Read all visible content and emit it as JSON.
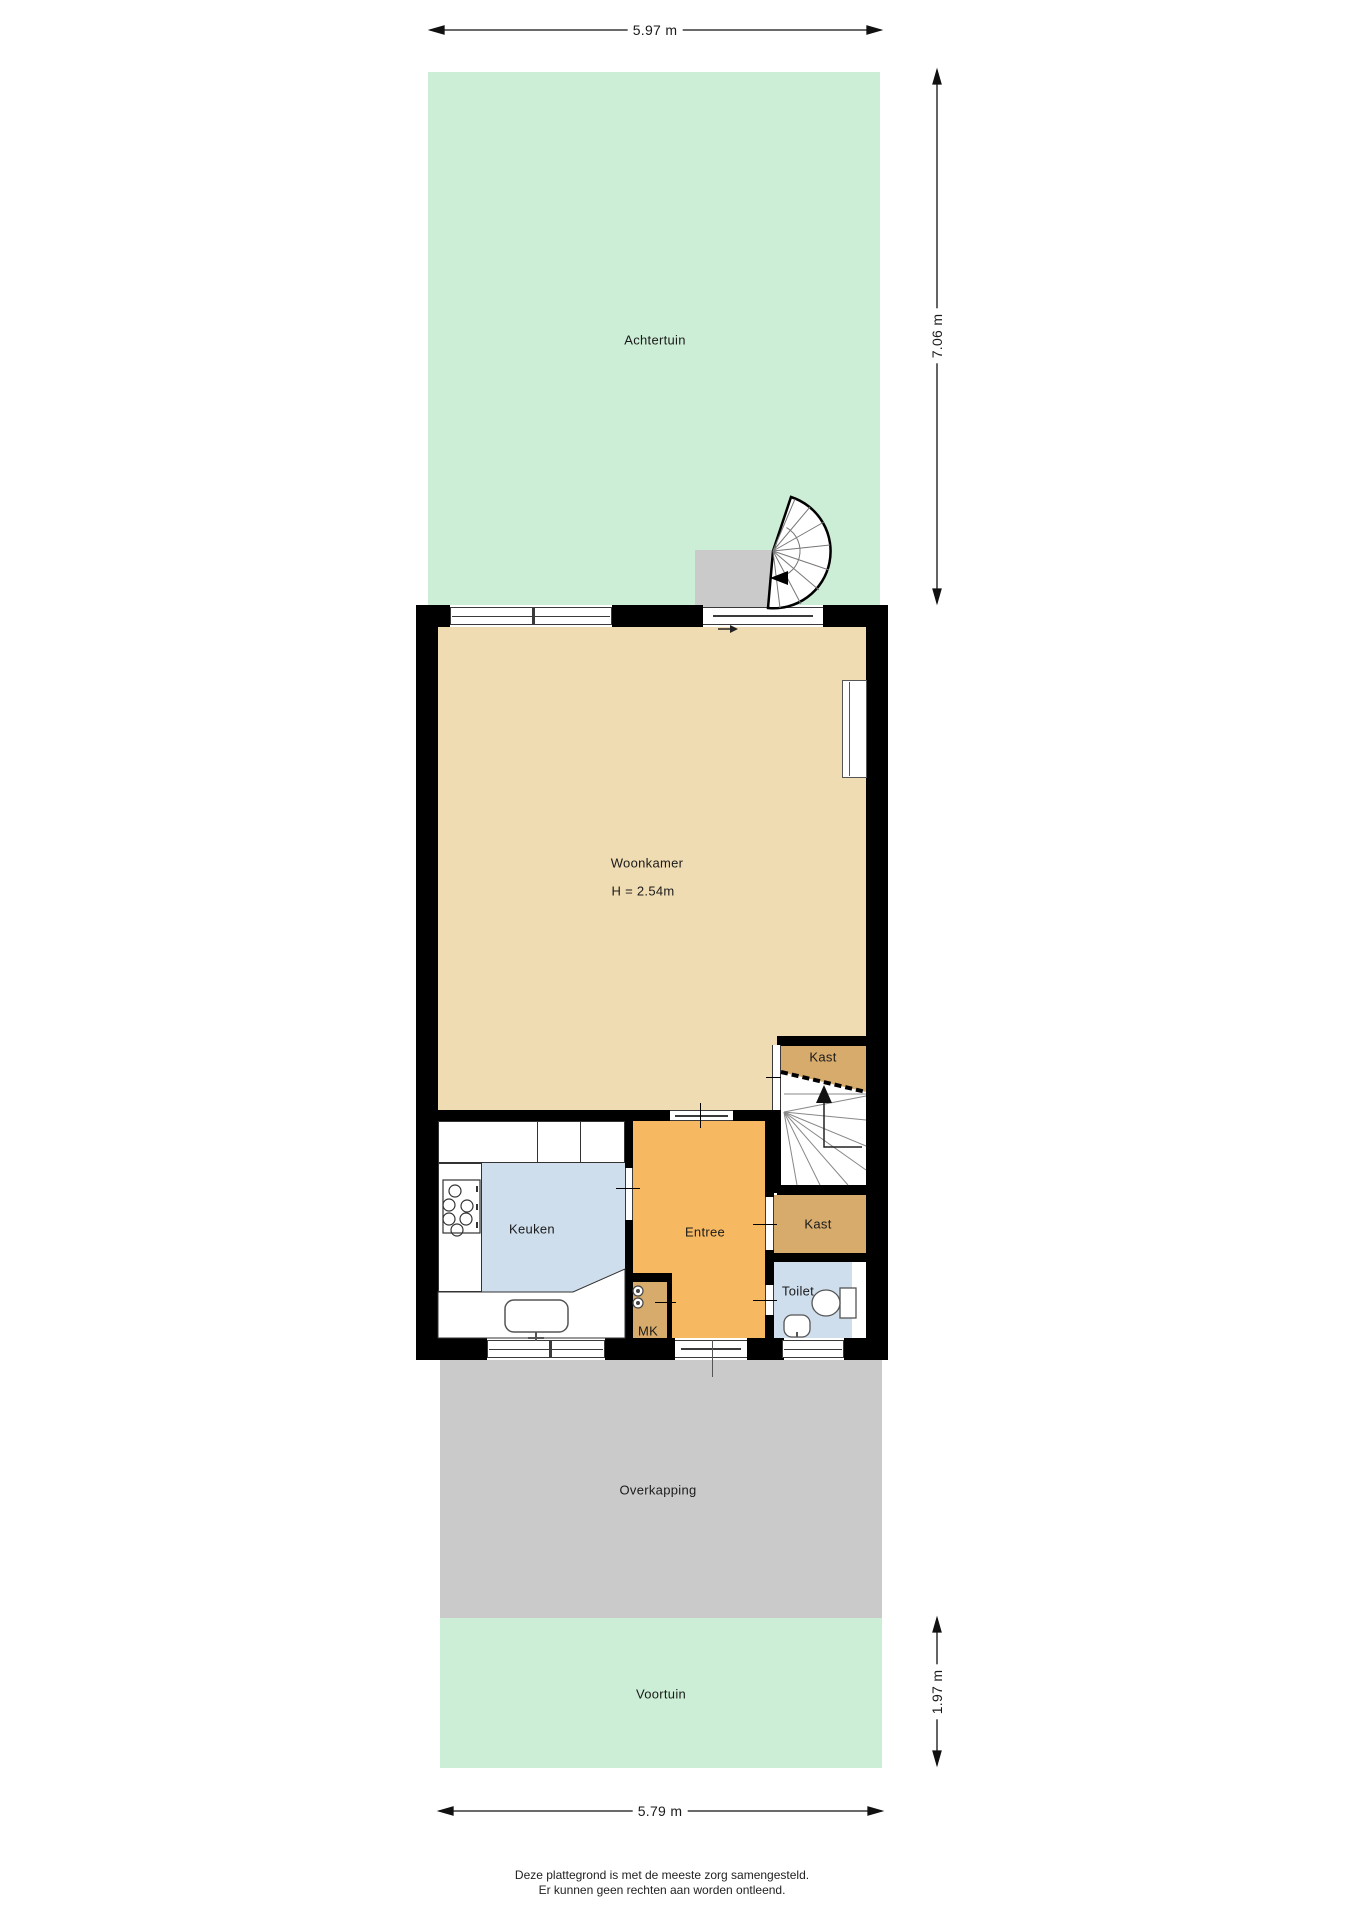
{
  "plan": {
    "type": "floorplan-begane-grond",
    "footer": {
      "line1": "Deze plattegrond is met de meeste zorg samengesteld.",
      "line2": "Er kunnen geen rechten aan worden ontleend."
    }
  },
  "rooms": {
    "achtertuin": {
      "label": "Achtertuin"
    },
    "woonkamer": {
      "label": "Woonkamer",
      "height": "H = 2.54m"
    },
    "kast_boven": {
      "label": "Kast"
    },
    "kast_onder": {
      "label": "Kast"
    },
    "keuken": {
      "label": "Keuken"
    },
    "entree": {
      "label": "Entree"
    },
    "toilet": {
      "label": "Toilet"
    },
    "mk": {
      "label": "MK"
    },
    "overkapping": {
      "label": "Overkapping"
    },
    "voortuin": {
      "label": "Voortuin"
    }
  },
  "dimensions": {
    "top_width": "5.97 m",
    "back_depth": "7.06 m",
    "front_depth": "1.97 m",
    "bottom_width": "5.79 m"
  },
  "colors": {
    "garden": "#cdeed6",
    "livingroom": "#f0dcb2",
    "closet": "#d6ab6b",
    "hall": "#f6b961",
    "kitchen": "#cfdeed",
    "canopy": "#cacaca",
    "wall": "#000000"
  }
}
